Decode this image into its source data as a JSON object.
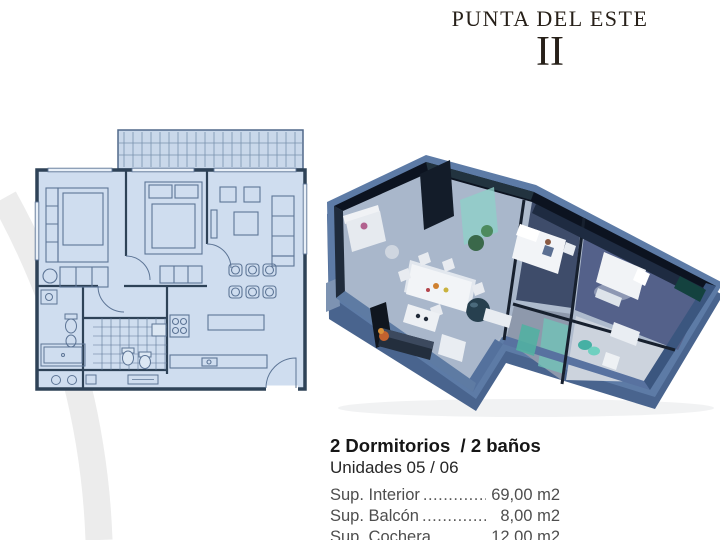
{
  "title": {
    "project": "PUNTA DEL ESTE",
    "phase": "II"
  },
  "details": {
    "headline": "2 Dormitorios  / 2 baños",
    "units": "Unidades 05 / 06",
    "rows": [
      {
        "label": "Sup. Interior",
        "dots": "....................................",
        "value": "69,00 m2"
      },
      {
        "label": "Sup. Balcón",
        "dots": "....................................",
        "value": "8,00 m2"
      },
      {
        "label": "Sup. Cochera",
        "dots": "....................................",
        "value": "12,00 m2"
      }
    ]
  },
  "colors": {
    "plan_fill": "#cfddef",
    "plan_wall": "#2e4257",
    "plan_furniture": "#5d7596",
    "render_platform": "#5d7ba6",
    "render_wall_dark": "#0c1320",
    "render_teal": "#49b0a2",
    "text_primary": "#1d1d1d",
    "text_secondary": "#4e4e4e",
    "watermark": "#ececec"
  }
}
